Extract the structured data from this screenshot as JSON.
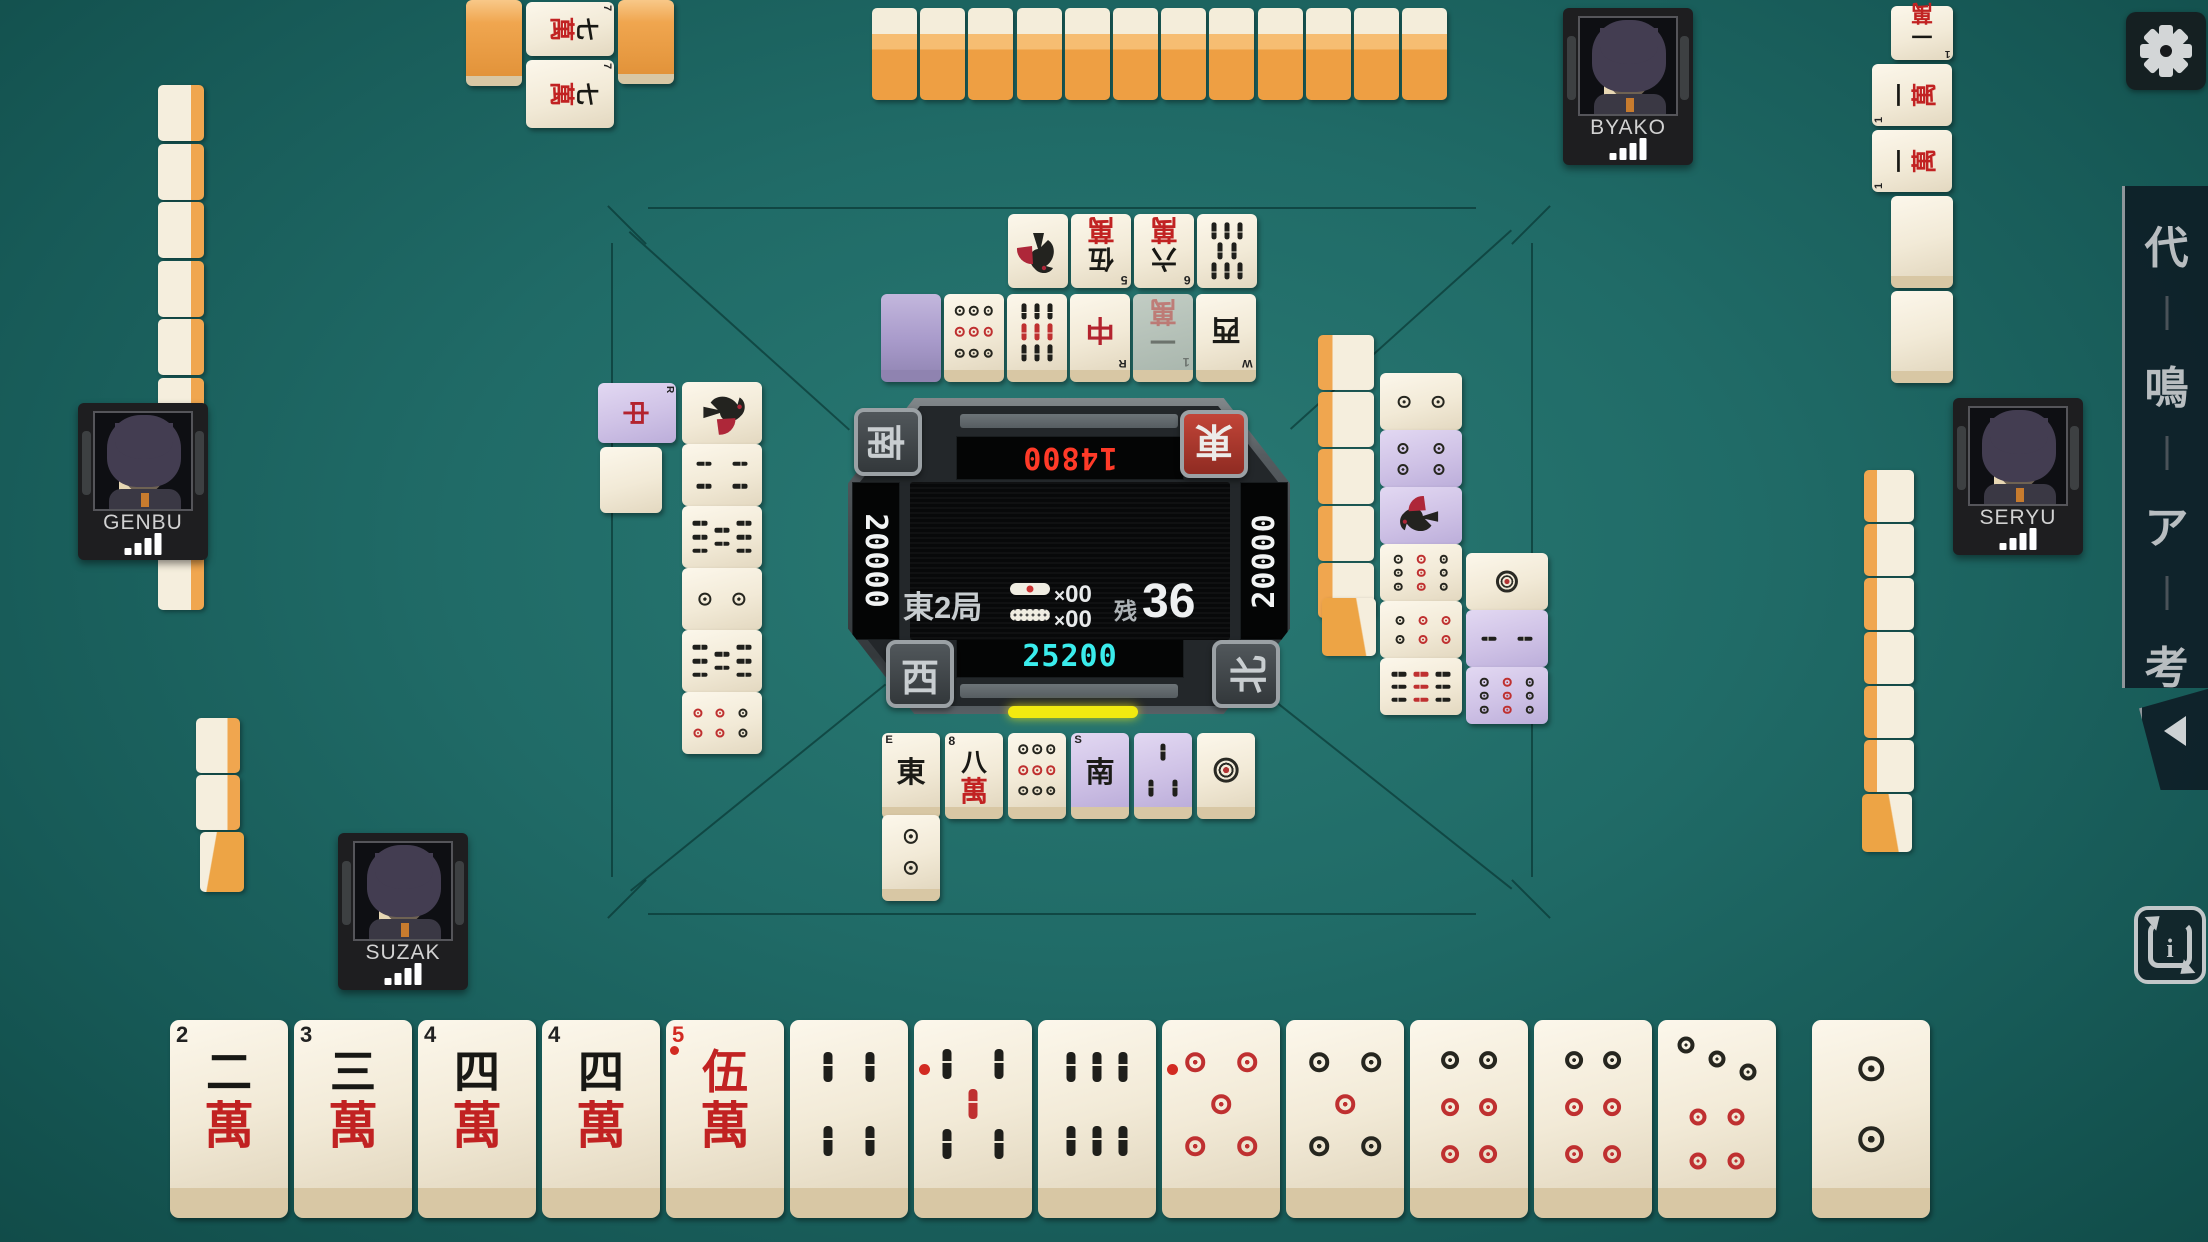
{
  "players": {
    "bottom": {
      "name": "SUZAK",
      "score": "25200",
      "seat_wind": "西",
      "score_color": "#3aecec"
    },
    "left": {
      "name": "GENBU",
      "score": "20000",
      "seat_wind": "南",
      "score_color": "#f2f4f4"
    },
    "top": {
      "name": "BYAKO",
      "score": "14800",
      "seat_wind": "東",
      "score_color": "#ff3a28",
      "dealer": true
    },
    "right": {
      "name": "SERYU",
      "score": "20000",
      "seat_wind": "北",
      "score_color": "#f2f4f4"
    }
  },
  "center": {
    "round": "東2局",
    "times_symbol": "×",
    "riichi_stick_count": "00",
    "honba_stick_count": "00",
    "remaining_label": "残",
    "remaining_tiles": "36",
    "dora_display": [
      "4p",
      "3m",
      "back",
      "back",
      "back"
    ]
  },
  "hand": {
    "tiles": [
      "2m",
      "3m",
      "4m",
      "4m",
      "0m",
      "4s",
      "0s",
      "6s",
      "0p",
      "5p",
      "6p",
      "6p",
      "7p"
    ],
    "drawn_tile": "2p"
  },
  "discards": {
    "top_outer_row": [
      "1s",
      "5m",
      "6m",
      "8s"
    ],
    "top_inner_row": [
      "pback",
      "9p",
      "9s",
      "dR",
      "1m:faded",
      "wW"
    ],
    "left_riichi_tile": "dR:purple",
    "left_col1_extra": "blank",
    "left_col2": [
      "1s",
      "4s",
      "8s",
      "2p",
      "8s",
      "6p"
    ],
    "right_col_inner": [
      "2p",
      "4p:purple",
      "1s:purple",
      "9p",
      "6p",
      "9s"
    ],
    "right_col_outer": [
      "1p",
      "2s:purple",
      "9p:purple"
    ],
    "bottom_row1": [
      "wE",
      "8m",
      "9p",
      "wS:purple",
      "3s:purple",
      "1p"
    ],
    "bottom_row2": [
      "2p"
    ]
  },
  "melds": {
    "top_player_kan": {
      "face_down_count": 2,
      "rotated_tiles": [
        "7m",
        "7m"
      ]
    },
    "right_player_pon": {
      "called_tile": "1m",
      "tiles": [
        "1m",
        "1m"
      ],
      "standing_blank_count": 2
    }
  },
  "walls": {
    "top_row_count": 12,
    "left_column_count": 9,
    "left_hand_count": 3,
    "right_column_count": 5,
    "right_hand_count": 7
  },
  "sidebar": {
    "buttons": [
      {
        "label": "代"
      },
      {
        "label": "鳴"
      },
      {
        "label": "ア"
      },
      {
        "label": "考"
      }
    ],
    "collapse_arrow": "",
    "replay_info_label": "i"
  },
  "colors": {
    "felt": "#206b67",
    "tile_back_orange": "#f0a64f",
    "tile_purple_tint": "#cfc2e6",
    "riichi_yellow": "#f2ea10",
    "dealer_red": "#b5372c",
    "score_red": "#ff3a28",
    "score_cyan": "#3aecec"
  }
}
